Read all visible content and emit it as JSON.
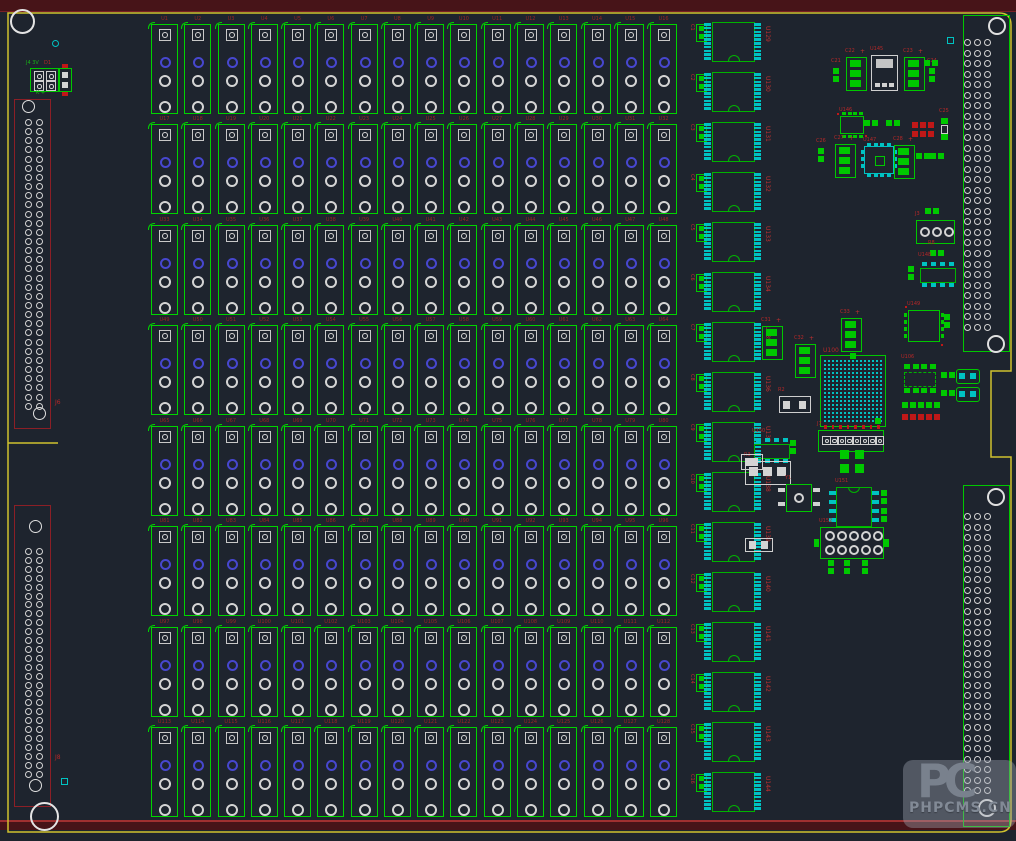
{
  "app": {
    "view": "pcb-layout"
  },
  "colors": {
    "background": "#1e242e",
    "board_outline_yellow": "#cfc12e",
    "edge_maroon": "#471418",
    "edge_red_line": "#a03030",
    "component_green": "#00c800",
    "pad_cyan": "#00c2c2",
    "pad_white": "#d4d4d4",
    "pad_blue": "#4747cf",
    "pad_red": "#c01818",
    "refdes_red": "#b42828",
    "connector_red_outline": "#8c1f26",
    "silk_white": "#cfcfcf"
  },
  "relay_grid": {
    "x0": 151,
    "y0": 17,
    "cols": 16,
    "rows": 8,
    "col_pitch": 33.27,
    "row_pitch": 100.43,
    "w": 25,
    "h": 88,
    "pad_centers": [
      10,
      37,
      56,
      82
    ],
    "labels": [
      "U1",
      "U2",
      "U3",
      "U4",
      "U5",
      "U6",
      "U7",
      "U8",
      "U9",
      "U10",
      "U11",
      "U12",
      "U13",
      "U14",
      "U15",
      "U16",
      "U17",
      "U18",
      "U19",
      "U20",
      "U21",
      "U22",
      "U23",
      "U24",
      "U25",
      "U26",
      "U27",
      "U28",
      "U29",
      "U30",
      "U31",
      "U32",
      "U33",
      "U34",
      "U35",
      "U36",
      "U37",
      "U38",
      "U39",
      "U40",
      "U41",
      "U42",
      "U43",
      "U44",
      "U45",
      "U46",
      "U47",
      "U48",
      "U49",
      "U50",
      "U51",
      "U52",
      "U53",
      "U54",
      "U55",
      "U56",
      "U57",
      "U58",
      "U59",
      "U60",
      "U61",
      "U62",
      "U63",
      "U64",
      "U65",
      "U66",
      "U67",
      "U68",
      "U69",
      "U70",
      "U71",
      "U72",
      "U73",
      "U74",
      "U75",
      "U76",
      "U77",
      "U78",
      "U79",
      "U80",
      "U81",
      "U82",
      "U83",
      "U84",
      "U85",
      "U86",
      "U87",
      "U88",
      "U89",
      "U90",
      "U91",
      "U92",
      "U93",
      "U94",
      "U95",
      "U96",
      "U97",
      "U98",
      "U99",
      "U100",
      "U101",
      "U102",
      "U103",
      "U104",
      "U105",
      "U106",
      "U107",
      "U108",
      "U109",
      "U110",
      "U111",
      "U112",
      "U113",
      "U114",
      "U115",
      "U116",
      "U117",
      "U118",
      "U119",
      "U120",
      "U121",
      "U122",
      "U123",
      "U124",
      "U125",
      "U126",
      "U127",
      "U128"
    ]
  },
  "dip_column": {
    "x": 691,
    "y0": 20,
    "pitch": 50,
    "count": 16,
    "labels": [
      "U129",
      "U130",
      "U131",
      "U132",
      "U133",
      "U134",
      "U135",
      "U136",
      "U137",
      "U138",
      "U139",
      "U140",
      "U141",
      "U142",
      "U143",
      "U144"
    ],
    "cap_labels": [
      "C1",
      "C2",
      "C3",
      "C4",
      "C5",
      "C6",
      "C7",
      "C8",
      "C9",
      "C10",
      "C11",
      "C12",
      "C13",
      "C14",
      "C15",
      "C16"
    ]
  },
  "left_connectors": [
    {
      "label": "J6",
      "x": 14,
      "y": 99,
      "w": 35,
      "h": 328,
      "rows": 32,
      "row_start": 119,
      "row_pitch": 9.15,
      "cols": [
        25,
        36
      ],
      "holes": [
        [
          29,
          107
        ],
        [
          40,
          414
        ]
      ],
      "label_pos": [
        55,
        400
      ]
    },
    {
      "label": "J8",
      "x": 14,
      "y": 505,
      "w": 35,
      "h": 300,
      "rows": 26,
      "row_start": 548,
      "row_pitch": 8.9,
      "cols": [
        25,
        36
      ],
      "holes": [
        [
          36,
          527
        ],
        [
          36,
          786
        ]
      ],
      "label_pos": [
        55,
        755
      ]
    }
  ],
  "right_connectors": [
    {
      "label": "J1",
      "x": 963,
      "y": 15,
      "w": 45,
      "h": 335,
      "rows": 28,
      "row_start": 39,
      "row_pitch": 10.55,
      "cols": [
        967,
        977,
        987
      ],
      "holes": [
        [
          997,
          26
        ],
        [
          996,
          344
        ]
      ]
    },
    {
      "label": "J2",
      "x": 963,
      "y": 485,
      "w": 45,
      "h": 340,
      "rows": 27,
      "row_start": 513,
      "row_pitch": 10.55,
      "cols": [
        967,
        977,
        987
      ],
      "holes": [
        [
          996,
          497
        ],
        [
          987,
          808
        ]
      ]
    }
  ],
  "bga": {
    "x": 820,
    "y": 355,
    "w": 64,
    "h": 70,
    "grid_cols": 15,
    "grid_rows": 16,
    "label": "U100"
  },
  "mounting_holes": [
    [
      22,
      21,
      12
    ],
    [
      44,
      816,
      14
    ]
  ],
  "vias": [
    {
      "x": 52,
      "y": 40,
      "kind": "ring"
    },
    {
      "x": 947,
      "y": 37,
      "kind": "sq"
    },
    {
      "x": 61,
      "y": 778,
      "kind": "sq"
    }
  ],
  "misc_texts": [
    {
      "text": "J4 3V",
      "x": 26,
      "y": 61,
      "color": "green"
    },
    {
      "text": "K +",
      "x": 36,
      "y": 91,
      "color": "green"
    },
    {
      "text": "D1",
      "x": 44,
      "y": 61,
      "color": "red"
    }
  ],
  "components": [
    {
      "t": "pad4box",
      "x": 30,
      "y": 68,
      "label": ""
    },
    {
      "t": "conn2",
      "x": 58,
      "y": 68,
      "label": ""
    },
    {
      "t": "p2v",
      "x": 833,
      "y": 68,
      "label": "C21"
    },
    {
      "t": "cap3",
      "x": 846,
      "y": 57,
      "label": "C22"
    },
    {
      "t": "reg",
      "x": 871,
      "y": 55,
      "label": "U145"
    },
    {
      "t": "cap3",
      "x": 904,
      "y": 57,
      "label": "C23"
    },
    {
      "t": "p2v",
      "x": 929,
      "y": 68,
      "label": "C24"
    },
    {
      "t": "p2h",
      "x": 924,
      "y": 60,
      "label": ""
    },
    {
      "t": "qfp_green",
      "x": 840,
      "y": 116,
      "label": "U146"
    },
    {
      "t": "p2h",
      "x": 864,
      "y": 120,
      "label": ""
    },
    {
      "t": "p2h",
      "x": 886,
      "y": 120,
      "label": ""
    },
    {
      "t": "sqrow_red",
      "x": 912,
      "y": 122,
      "n": 3
    },
    {
      "t": "sqrow_red",
      "x": 912,
      "y": 131,
      "n": 3
    },
    {
      "t": "cap2v",
      "x": 941,
      "y": 118,
      "label": "C25"
    },
    {
      "t": "p2v",
      "x": 818,
      "y": 148,
      "label": "C26"
    },
    {
      "t": "cap3",
      "x": 835,
      "y": 144,
      "label": "C27"
    },
    {
      "t": "qfp_cyan",
      "x": 864,
      "y": 146,
      "label": "U147"
    },
    {
      "t": "cap3",
      "x": 894,
      "y": 145,
      "label": "C28"
    },
    {
      "t": "p2h",
      "x": 916,
      "y": 153,
      "label": ""
    },
    {
      "t": "p2h",
      "x": 930,
      "y": 153,
      "label": ""
    },
    {
      "t": "p2h",
      "x": 925,
      "y": 208,
      "label": ""
    },
    {
      "t": "header3",
      "x": 916,
      "y": 220,
      "label": "J3"
    },
    {
      "t": "p2h",
      "x": 930,
      "y": 250,
      "label": "R8"
    },
    {
      "t": "soic8",
      "x": 920,
      "y": 262,
      "label": "U148"
    },
    {
      "t": "p2v",
      "x": 908,
      "y": 266,
      "label": ""
    },
    {
      "t": "qfn",
      "x": 908,
      "y": 310,
      "label": "U149"
    },
    {
      "t": "p2v",
      "x": 944,
      "y": 314,
      "label": ""
    },
    {
      "t": "cap3",
      "x": 762,
      "y": 326,
      "label": "C31"
    },
    {
      "t": "cap3",
      "x": 795,
      "y": 344,
      "label": "C32"
    },
    {
      "t": "cap3",
      "x": 841,
      "y": 318,
      "label": "C33"
    },
    {
      "t": "resnet2w",
      "x": 779,
      "y": 396,
      "w": 30,
      "h": 15,
      "label": "R2"
    },
    {
      "t": "header8",
      "x": 818,
      "y": 430,
      "label": "J7"
    },
    {
      "t": "soic8",
      "x": 754,
      "y": 438,
      "label": "U150"
    },
    {
      "t": "p2v",
      "x": 790,
      "y": 440,
      "label": ""
    },
    {
      "t": "resnet3w",
      "x": 745,
      "y": 461,
      "label": "R3"
    },
    {
      "t": "osc",
      "x": 786,
      "y": 484,
      "label": "Y1"
    },
    {
      "t": "pad4green",
      "x": 840,
      "y": 450,
      "label": ""
    },
    {
      "t": "sideic",
      "x": 836,
      "y": 487,
      "label": "U151"
    },
    {
      "t": "p2v",
      "x": 881,
      "y": 490,
      "label": ""
    },
    {
      "t": "p2v",
      "x": 881,
      "y": 508,
      "label": ""
    },
    {
      "t": "dipsocket",
      "x": 820,
      "y": 527,
      "label": "U152"
    },
    {
      "t": "p2v",
      "x": 828,
      "y": 560,
      "label": ""
    },
    {
      "t": "p2v",
      "x": 844,
      "y": 560,
      "label": ""
    },
    {
      "t": "p2v",
      "x": 862,
      "y": 560,
      "label": ""
    },
    {
      "t": "resnet2w",
      "x": 741,
      "y": 454,
      "w": 20,
      "h": 14,
      "label": ""
    },
    {
      "t": "resnet2w",
      "x": 745,
      "y": 538,
      "w": 26,
      "h": 12,
      "label": ""
    },
    {
      "t": "soic8g",
      "x": 903,
      "y": 364,
      "label": "U106"
    },
    {
      "t": "sqrow_green",
      "x": 902,
      "y": 402,
      "n": 5
    },
    {
      "t": "sqrow_red",
      "x": 902,
      "y": 414,
      "n": 5
    },
    {
      "t": "p2h",
      "x": 941,
      "y": 372,
      "label": ""
    },
    {
      "t": "smdres",
      "x": 956,
      "y": 369,
      "label": ""
    },
    {
      "t": "p2h",
      "x": 941,
      "y": 390,
      "label": ""
    },
    {
      "t": "smdres",
      "x": 956,
      "y": 387,
      "label": ""
    }
  ],
  "watermark": {
    "logo_text": "PC",
    "site_text": "PHPCMS.CN"
  }
}
